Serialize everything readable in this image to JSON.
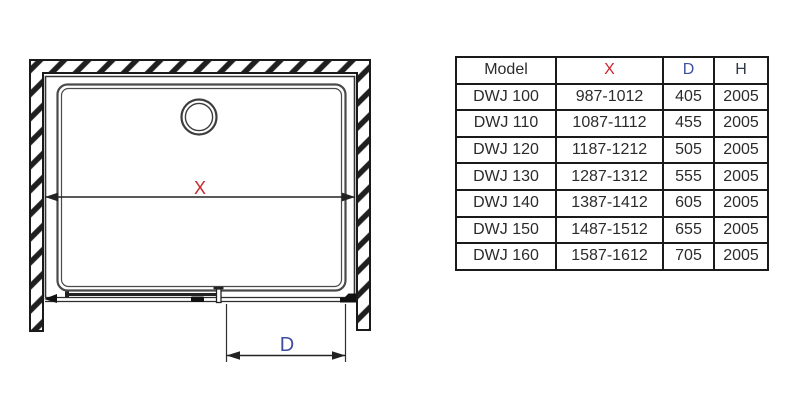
{
  "drawing": {
    "x_label": "X",
    "d_label": "D",
    "x_label_color": "#c9252c",
    "d_label_color": "#3f4fa0"
  },
  "table": {
    "headers": {
      "model": "Model",
      "x": "X",
      "d": "D",
      "h": "H"
    },
    "rows": [
      {
        "model": "DWJ 100",
        "x": "987-1012",
        "d": "405",
        "h": "2005"
      },
      {
        "model": "DWJ 110",
        "x": "1087-1112",
        "d": "455",
        "h": "2005"
      },
      {
        "model": "DWJ 120",
        "x": "1187-1212",
        "d": "505",
        "h": "2005"
      },
      {
        "model": "DWJ 130",
        "x": "1287-1312",
        "d": "555",
        "h": "2005"
      },
      {
        "model": "DWJ 140",
        "x": "1387-1412",
        "d": "605",
        "h": "2005"
      },
      {
        "model": "DWJ 150",
        "x": "1487-1512",
        "d": "655",
        "h": "2005"
      },
      {
        "model": "DWJ 160",
        "x": "1587-1612",
        "d": "705",
        "h": "2005"
      }
    ]
  },
  "colors": {
    "accent_red": "#c9252c",
    "accent_blue": "#3f4fa0",
    "line": "#3a3a3a",
    "table_border": "#1a1a1a"
  }
}
